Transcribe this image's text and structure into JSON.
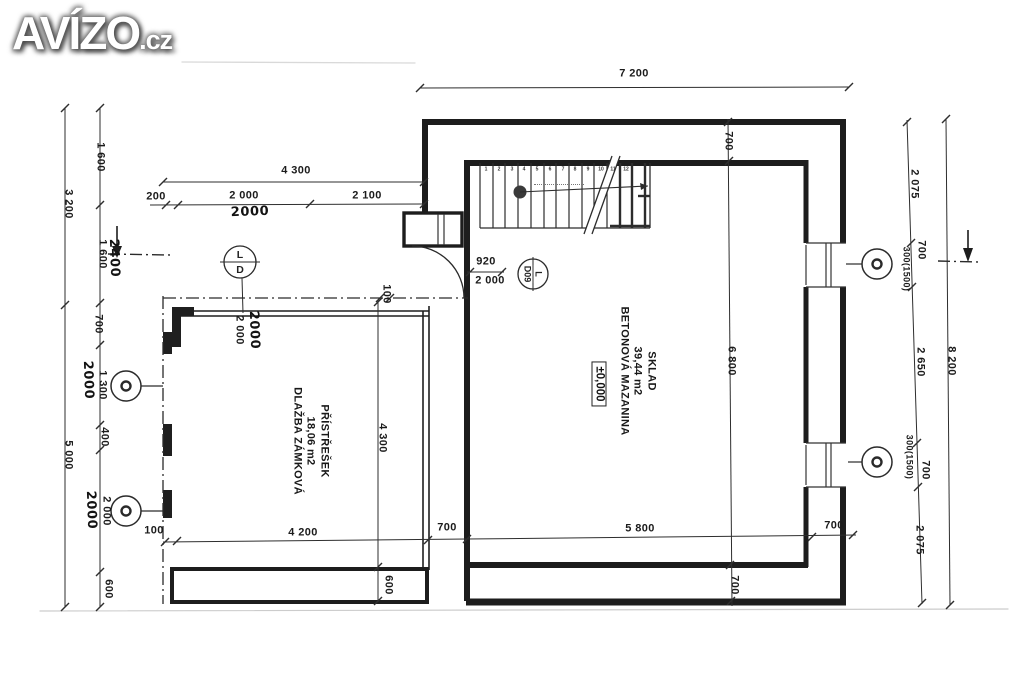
{
  "logo": {
    "title": "AVÍZO",
    "tld": ".cz"
  },
  "rooms": [
    {
      "name": "SKLAD",
      "area": "39,44 m2",
      "floor": "BETONOVÁ MAZANINA",
      "level": "±0,000"
    },
    {
      "name": "PŘÍSTŘEŠEK",
      "area": "18,06 m2",
      "floor": "DLAŽBA ZÁMKOVÁ"
    }
  ],
  "markers": {
    "ld_top": "L",
    "ld_bottom": "D",
    "door_label": "L",
    "door_code": "D09"
  },
  "stairs": {
    "treads": [
      "1",
      "2",
      "3",
      "4",
      "5",
      "6",
      "7",
      "8",
      "9",
      "10",
      "11",
      "12"
    ]
  },
  "dims": {
    "top_width": "7 200",
    "left_3200": "3 200",
    "left_5000": "5 000",
    "l_1600a": "1 600",
    "l_1600b": "1 600",
    "l_700": "700",
    "l_1300": "1 300",
    "l_400": "400",
    "l_2000": "2 000",
    "l_600": "600",
    "h_2400": "2400",
    "h_2000a": "2000",
    "h_2000b": "2000",
    "h_2000c": "2000",
    "t_4300": "4 300",
    "t_200": "200",
    "t_2000": "2 000",
    "t_2100": "2 100",
    "g_2000a": "2 000",
    "g_2000b": "2000",
    "e_100": "100",
    "p_4300": "4 300",
    "p_600": "600",
    "b_100": "100",
    "b_4200": "4 200",
    "b_700a": "700",
    "b_5800": "5 800",
    "b_700b": "700",
    "b_700c": "700",
    "m_700": "700",
    "m_6800": "6 800",
    "r_2075t": "2 075",
    "r_700t": "700",
    "r_300t": "300(1500)",
    "r_2650": "2 650",
    "r_300b": "300(1500)",
    "r_700b": "700",
    "r_2075b": "2 075",
    "r_8200": "8 200",
    "door_w": "920",
    "door_h": "2 000"
  }
}
